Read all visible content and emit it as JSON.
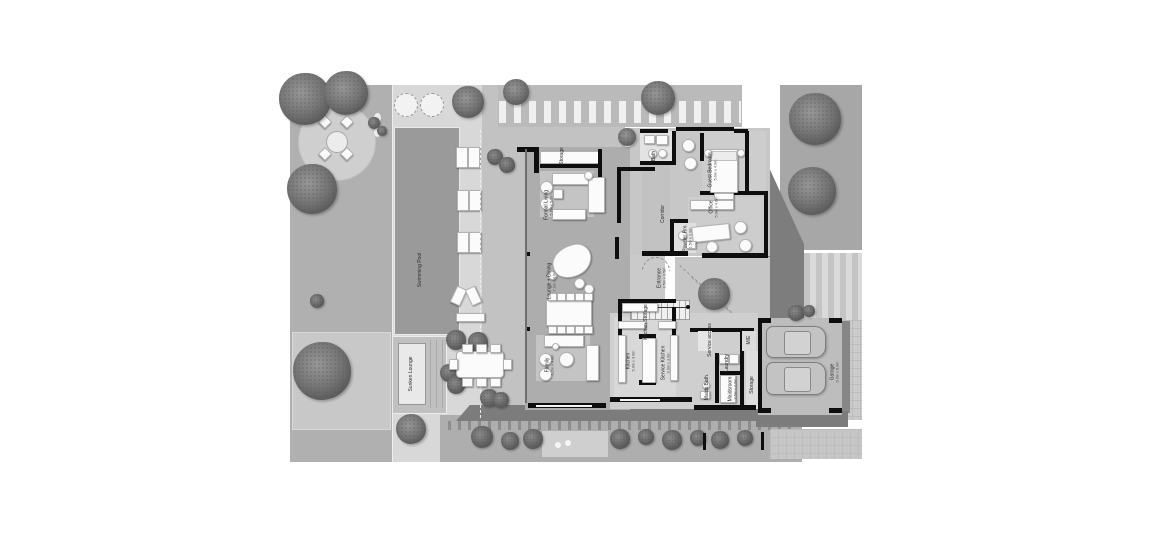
{
  "colors": {
    "walls": "#0e0e0e",
    "pool": "#9a9a9a",
    "garden": "#b0b0b0",
    "deck": "#d8d8d8",
    "shadow": "#7d7d7d",
    "paper": "#ffffff"
  },
  "rooms": {
    "swimming_pool": {
      "label": "Swimming Pool"
    },
    "sunken_lounge": {
      "label": "Sunken Lounge"
    },
    "pool_storage": {
      "label": "Storage"
    },
    "formal_living": {
      "label": "Formal Living",
      "dims": "5.6m x 5.2m"
    },
    "lounge_dining": {
      "label": "Lounge + Dining",
      "dims": "7.2m x 4.0m"
    },
    "family": {
      "label": "Family",
      "dims": "5.2m x 4.8m"
    },
    "corridor": {
      "label": "Corridor"
    },
    "powder_room": {
      "label": "Powder Rm.",
      "dims": "1.5m x 2.0m"
    },
    "entrance": {
      "label": "Entrance",
      "dims": "3.5m x 3.5m"
    },
    "bath": {
      "label": "Bath"
    },
    "guest_bedroom": {
      "label": "Guest Bedroom",
      "dims": "5.0m x 4.0m"
    },
    "office": {
      "label": "Office",
      "dims": "5.0m x 4.0m"
    },
    "kitchen_storage": {
      "label": "Kitchen Storage"
    },
    "kitchen": {
      "label": "Kitchen",
      "dims": "5.0m x 3.0m"
    },
    "service_kitchen": {
      "label": "Service Kitchen",
      "dims": "3.0m x 3.0m"
    },
    "service_access": {
      "label": "Service access"
    },
    "laundry": {
      "label": "Laundry"
    },
    "mech_elec": {
      "label": "M/E"
    },
    "maids_bath": {
      "label": "Maids Bath."
    },
    "maids_room": {
      "label": "Maidsroom",
      "dims": "2.5m x 2.0m"
    },
    "garage_storage": {
      "label": "Storage"
    },
    "garage": {
      "label": "Garage",
      "dims": "6.0m x 6.0m"
    }
  }
}
